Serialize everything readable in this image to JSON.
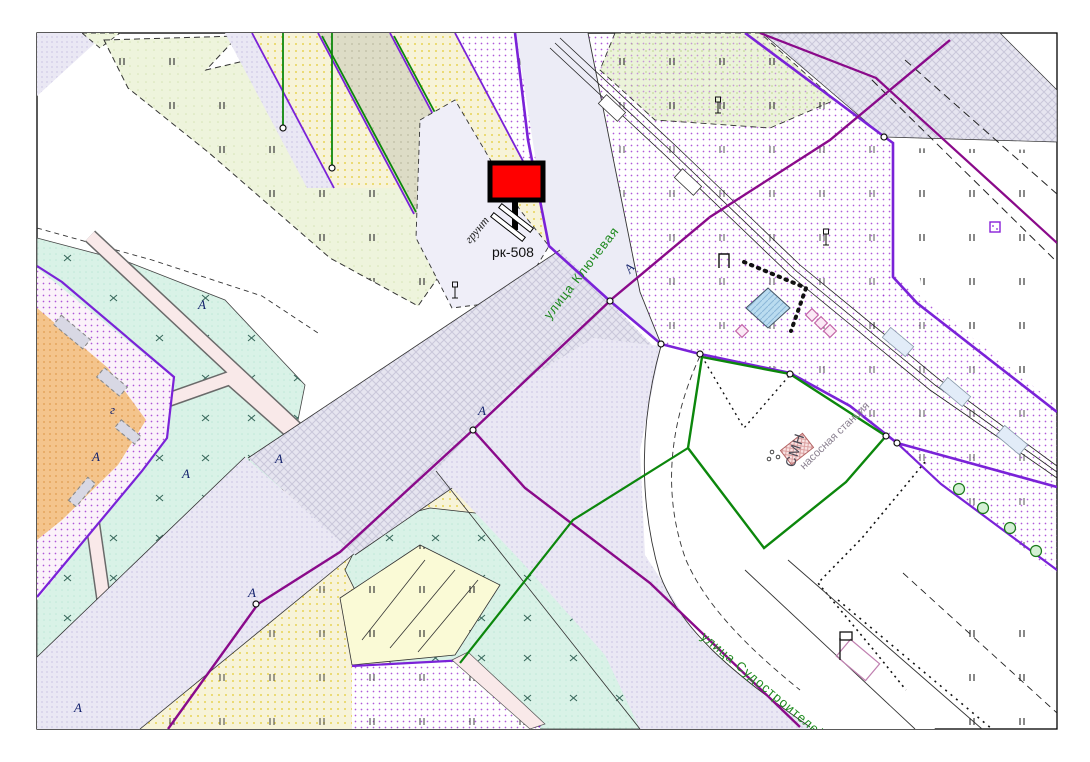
{
  "map": {
    "billboard": {
      "code": "рк-508",
      "ground_label": "грунт",
      "panel_color": "#ff0000"
    },
    "streets": {
      "street_1": "улица Ключевая",
      "street_2": "улица Судостроителей"
    },
    "site": {
      "abbr": "СМН",
      "name": "насосная станция"
    },
    "markers": {
      "axis_letter": "А",
      "building_letter": "г"
    },
    "colors": {
      "boundary_violet": "#7a22d8",
      "road_axis_magenta": "#8a0a8a",
      "street_label_green": "#1f8a1f",
      "site_boundary_green": "#0c870c",
      "billboard_red": "#ff0000",
      "pool_blue": "#badcf0"
    }
  }
}
